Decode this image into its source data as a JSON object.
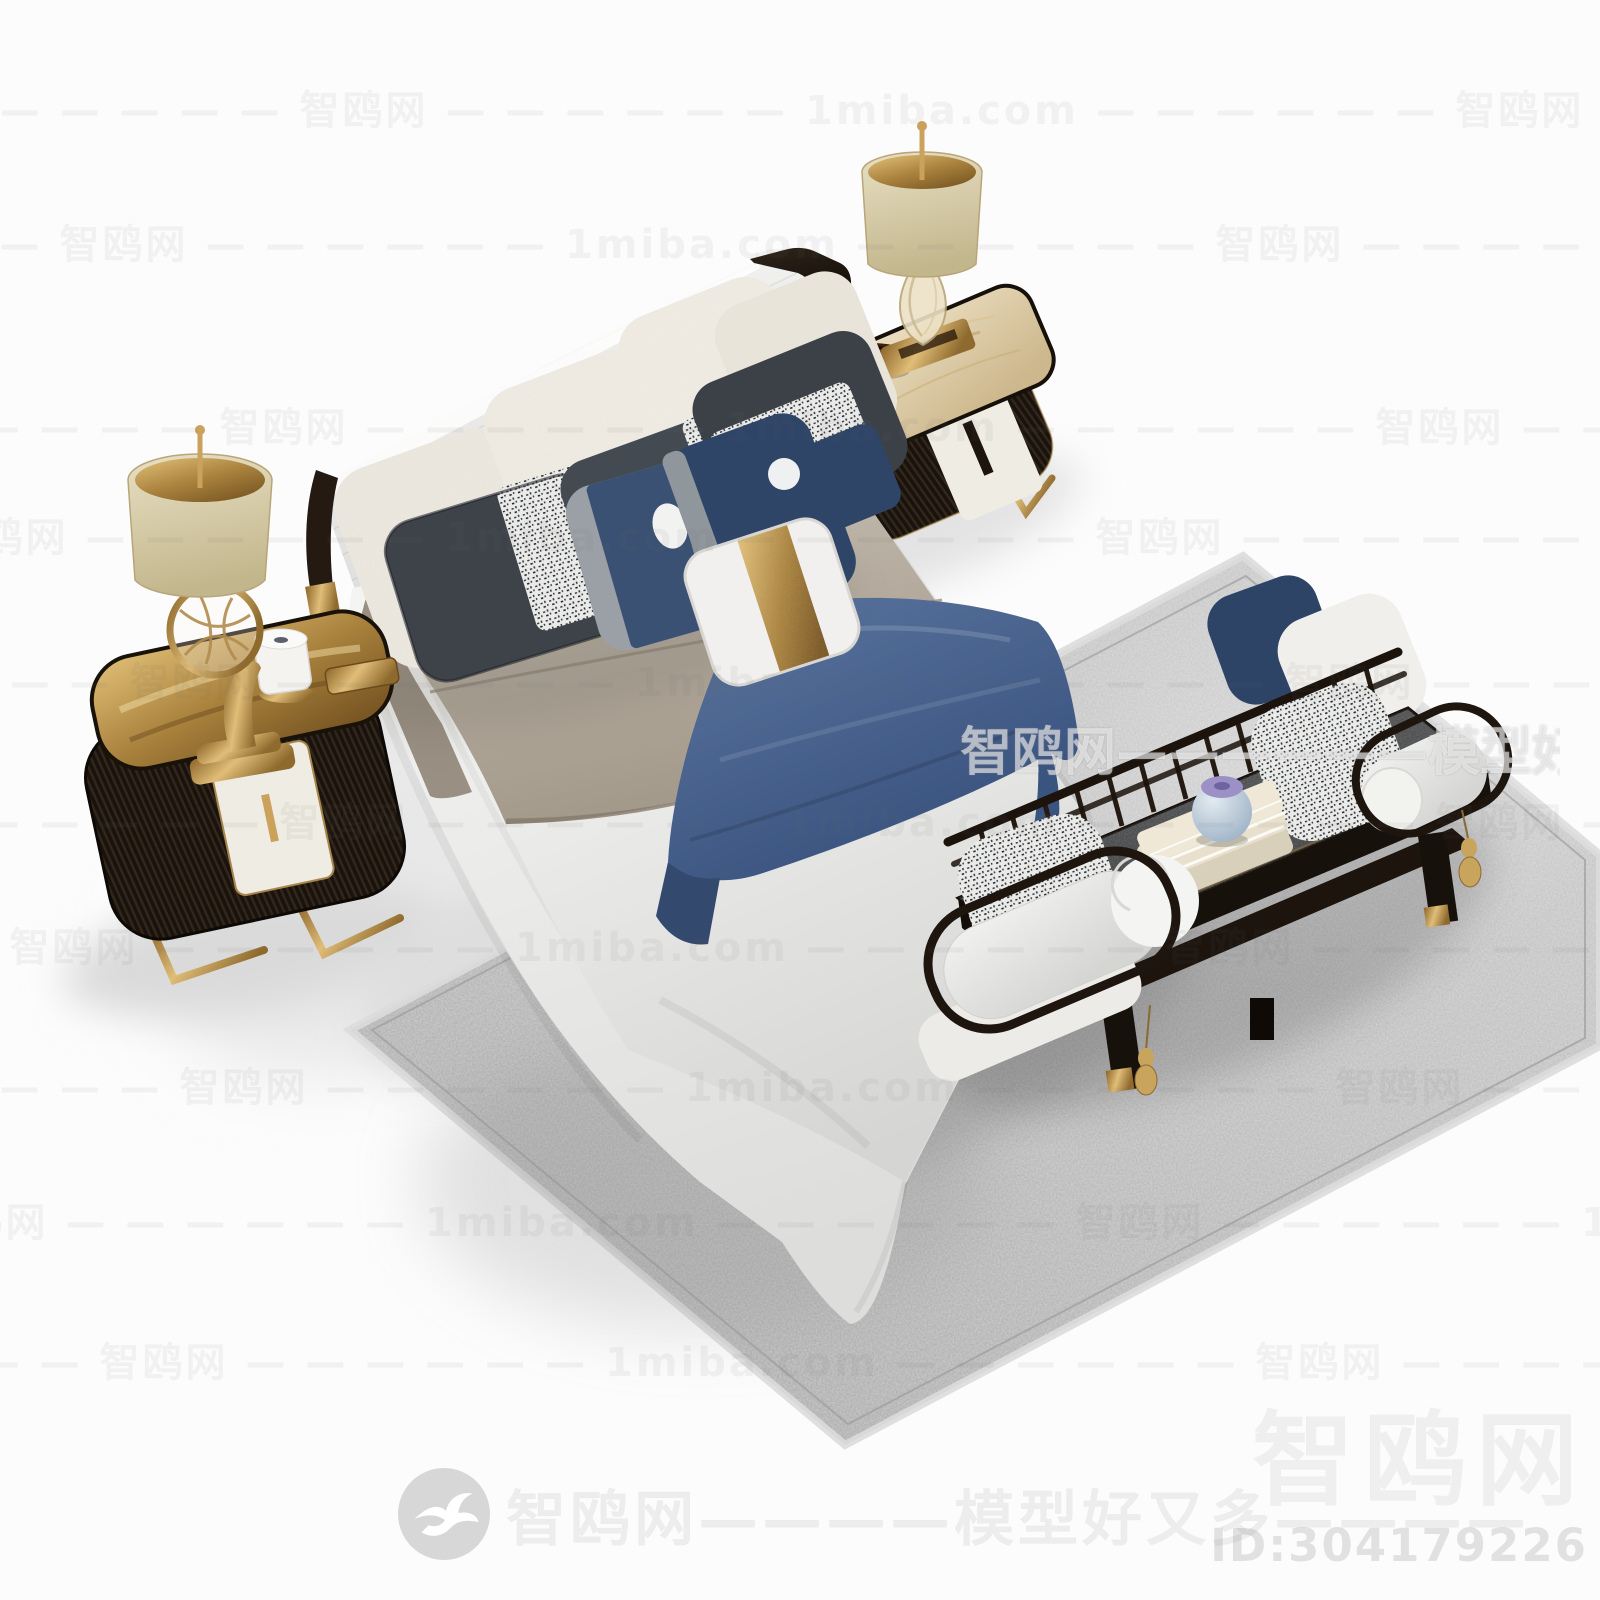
{
  "meta": {
    "type": "3d-model-product-render",
    "subject": "New Chinese style bedroom set: white channel-tufted bed with layered taupe and white bedding, blue bed runner, decorative pillows, two dark ribbed nightstands with brass table lamps, spindle-back bench with bolster cushions, books and a small blue vase, on a grey shagreen rug",
    "background": "#fcfcfc"
  },
  "watermarks": {
    "site_name": "智鸥网",
    "site_domain": "1miba.com",
    "tagline": "模型好又多",
    "tiled_row_text": "— — — — — — 智鸥网 — — — — — — 1miba.com — — — — — — 智鸥网 — — — — — — 1miba.com — — — — — — 智鸥网 — — — — — — 1miba.com — — — — — — 智鸥网 — — — — — — 1miba.com — — — — — —",
    "center_overlay_text": "智鸥网——————模型好又多————",
    "footer_text": "智鸥网————模型好又多————",
    "footer_logo": "seagull-icon",
    "corner_logo_text": "智鸥网",
    "corner_id_text": "ID:304179226"
  },
  "scene": {
    "items": [
      "bed",
      "headboard",
      "pillows",
      "duvet",
      "throw-blanket",
      "bed-runner",
      "nightstand-left",
      "nightstand-right",
      "table-lamp-left",
      "table-lamp-right",
      "aroma-diffuser",
      "trinket-box",
      "wood-bowl",
      "bench",
      "bolster-cushions",
      "speckled-pillows",
      "books",
      "blue-vase",
      "gold-tassels",
      "shagreen-rug"
    ],
    "colors": {
      "duvet_taupe": "#b3a99c",
      "sheet_white": "#eeedeb",
      "runner_blue": "#44608c",
      "pillow_charcoal": "#3c4148",
      "pillow_navy": "#2e4568",
      "brass_gold": "#b08c4e",
      "wood_dark": "#1e1510",
      "rug_grey": "#bdbdbd",
      "lampshade_cream": "#d7cdaf",
      "vase_blue": "#b9cada",
      "vase_lid_lilac": "#9f93c8"
    }
  }
}
